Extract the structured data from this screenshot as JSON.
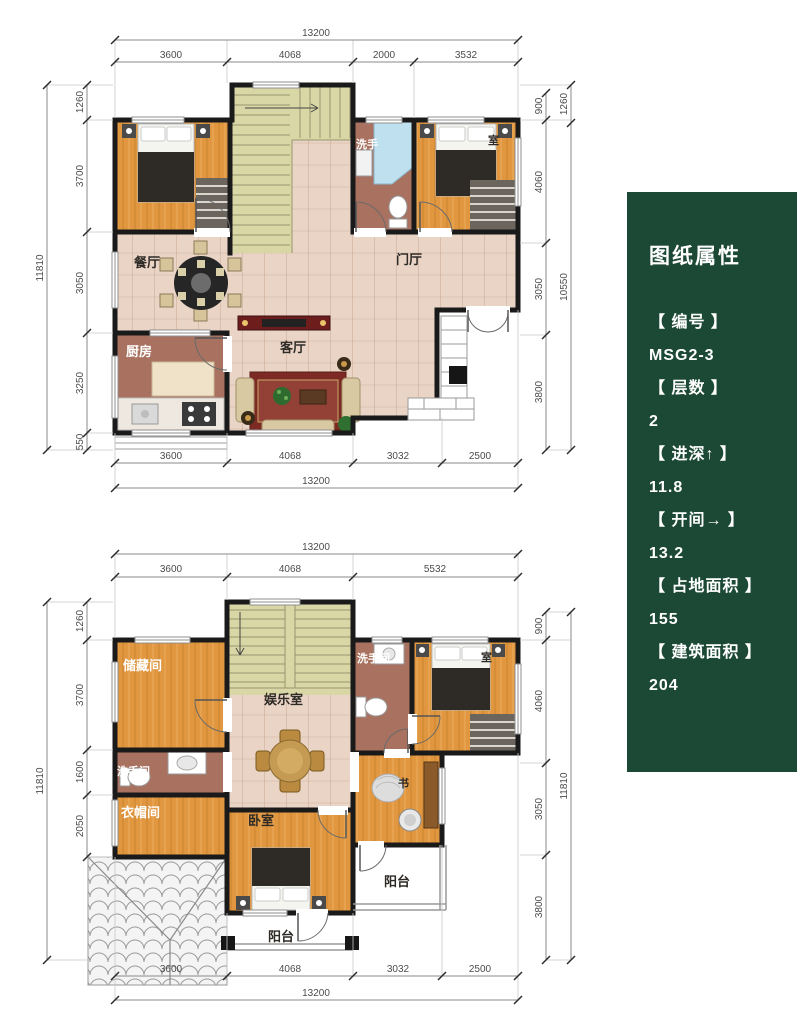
{
  "panel": {
    "title": "图纸属性",
    "items": [
      {
        "label": "【 编号 】",
        "value": "MSG2-3"
      },
      {
        "label": "【 层数 】",
        "value": "2"
      },
      {
        "label": "【 进深↑  】",
        "value": "11.8"
      },
      {
        "label": "【 开间→ 】",
        "value": "13.2"
      },
      {
        "label": "【 占地面积 】",
        "value": "155"
      },
      {
        "label": "【 建筑面积 】",
        "value": "204"
      }
    ]
  },
  "floor1": {
    "rooms": {
      "dining": "餐厅",
      "foyer": "门厅",
      "kitchen": "厨房",
      "living": "客厅",
      "washroom": "洗手",
      "bedroom_right": "室"
    },
    "dims": {
      "top_total": "13200",
      "top_segments": [
        "3600",
        "4068",
        "2000",
        "3532"
      ],
      "bottom_segments": [
        "3600",
        "4068",
        "3032",
        "2500"
      ],
      "bottom_total": "13200",
      "left_total": "11810",
      "left_segments": [
        "1260",
        "3700",
        "3050",
        "3250",
        "550"
      ],
      "right_segments": [
        "900",
        "4060",
        "3050",
        "3800"
      ],
      "right_outer_segments": [
        "1260",
        "10550"
      ]
    }
  },
  "floor2": {
    "rooms": {
      "storage": "储藏间",
      "recreation": "娱乐室",
      "washroom_top": "洗手间",
      "bedroom_right": "室",
      "washroom_left": "洗手间",
      "cloakroom": "衣帽间",
      "bedroom": "卧室",
      "study": "书",
      "balcony_right": "阳台",
      "balcony_bottom": "阳台"
    },
    "dims": {
      "top_total": "13200",
      "top_segments": [
        "3600",
        "4068",
        "5532"
      ],
      "bottom_segments": [
        "3600",
        "4068",
        "3032",
        "2500"
      ],
      "bottom_total": "13200",
      "left_total": "11810",
      "left_segments": [
        "1260",
        "3700",
        "1600",
        "2050"
      ],
      "right_segments": [
        "900",
        "4060",
        "3050",
        "3800"
      ],
      "right_total": "11810"
    }
  }
}
